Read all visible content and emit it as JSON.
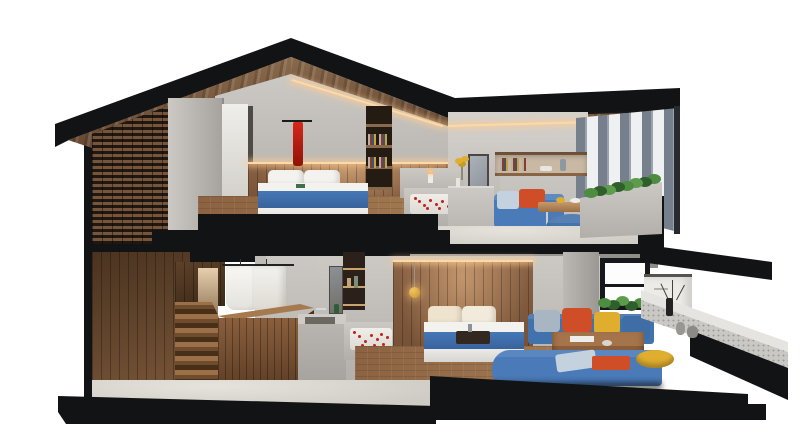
{
  "scene": {
    "description": "3D cutaway cross-section render of a modern two-story gabled house on a white background",
    "render_style": "architectural dollhouse section, black cut faces, wood and concrete interior",
    "background": "#ffffff",
    "palette": {
      "white": "#ffffff",
      "ink": "#121315",
      "concA": "#ccc9c4",
      "concB": "#b2afaa",
      "concC": "#a6a39e",
      "tileA": "#e6e3dc",
      "tileB": "#cfccc5",
      "woodCeilA": "#8b6b4d",
      "woodCeilB": "#654832",
      "woodVA": "#8a6245",
      "woodVB": "#6d4a2f",
      "woodDark": "#5d4129",
      "woodFloorA": "#a27a52",
      "woodFloorB": "#8b6342",
      "latticeSlat": "#76553a",
      "latticeGap": "#201711",
      "louver": "#75808c",
      "louverLine": "#9aa3ad",
      "gapWhite": "#eef0f1",
      "bedWhite": "#f3f2ee",
      "blue": "#4678b6",
      "sofaBlue": "#4a7ab8",
      "pouf": "#4474a9",
      "orange": "#cf4e28",
      "yellow": "#dfae2e",
      "lightBlue": "#c4d2e0",
      "cream": "#eee3cd",
      "green": "#4e8c42",
      "greenD": "#2f5f2a",
      "greenL": "#5d9c4c",
      "towel": "#d6281a",
      "gold": "#c8942f",
      "petal": "#c21f1f",
      "led": "#ffd9a5",
      "chrome": "#c9ccd0",
      "mirror": "#8b9299"
    },
    "structure": {
      "roof": "black gabled fascia with wood plank soffit, flat black wing roof to the right",
      "mid_slab": "black stepped floor slab between levels, sloping black beam at right end",
      "base": "black plinth with stepped right edge",
      "left_facade": "wooden brick lattice screen wall",
      "right_facade": "vertical louver fins over planter"
    },
    "upper_floor": {
      "rooms": [
        {
          "name": "master bedroom",
          "objects": [
            "double bed with blue band and white pillows",
            "wood plank headboard wall with LED glow",
            "red towel on rail",
            "recessed bookshelf niche",
            "concrete wardrobe volume",
            "bright door panel",
            "wood floor"
          ]
        },
        {
          "name": "open bathroom",
          "objects": [
            "sunken bathtub with rose petals",
            "candle ledge",
            "partition wall with mirror",
            "yellow flowers in vase",
            "black steps down"
          ]
        },
        {
          "name": "lounge",
          "objects": [
            "blue sofa with orange and light-blue pillows",
            "wood coffee table on chrome legs",
            "round blue ottoman",
            "recessed wall shelf with books",
            "concrete planter with green plants",
            "louvered facade"
          ]
        }
      ]
    },
    "lower_floor": {
      "rooms": [
        {
          "name": "stair hall / dressing",
          "objects": [
            "dark wood plank wall",
            "wood staircase with warm light",
            "clothes rail with white shirts",
            "wood chest island",
            "grey wardrobe panel with towel bar"
          ]
        },
        {
          "name": "bathroom",
          "objects": [
            "backlit shelf niche with bottles",
            "mirror strip",
            "concrete vanity with sunken sink and green bottle",
            "sunken bathtub with rose petals",
            "light tile floor"
          ]
        },
        {
          "name": "bedroom",
          "objects": [
            "wood headboard wall with glow",
            "gold pendant lamp",
            "double bed with cream pillows and blue band",
            "dark breakfast tray",
            "wood plank floor"
          ]
        },
        {
          "name": "sunken lounge",
          "objects": [
            "blue sectional sofa",
            "grey, orange, yellow and blue cushions",
            "large wood coffee table",
            "light-blue and orange throw cushions",
            "yellow pouf",
            "window with black frame",
            "green window planter",
            "white cabinet",
            "concrete column",
            "speckled terrace ledge",
            "black branch vase with twigs",
            "grey vases"
          ]
        }
      ]
    }
  }
}
